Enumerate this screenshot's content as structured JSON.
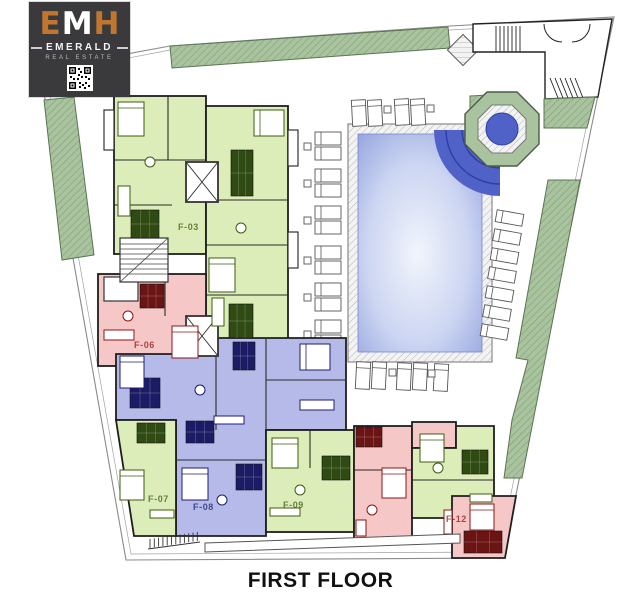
{
  "logo": {
    "letter_e": "E",
    "letter_m": "M",
    "letter_h": "H",
    "brand": "EMERALD",
    "subtitle": "REAL ESTATE"
  },
  "title": "FIRST FLOOR",
  "units": [
    {
      "id": "F-03",
      "color": "green"
    },
    {
      "id": "F-06",
      "color": "red"
    },
    {
      "id": "F-07",
      "color": "green"
    },
    {
      "id": "F-08",
      "color": "blue"
    },
    {
      "id": "F-09",
      "color": "green"
    },
    {
      "id": "F-12",
      "color": "red"
    }
  ],
  "icons": {
    "qr": "qr-code"
  },
  "colors": {
    "accent_orange": "#c0762f",
    "logo_bg": "#3a393b",
    "green_fill": "#dcedb9",
    "green_dark": "#3c5c10",
    "red_fill": "#f6c7c7",
    "red_dark": "#8c1616",
    "blue_fill": "#b5bae8",
    "blue_dark": "#1d1d72",
    "wall": "#1e1e1e",
    "landscape_fill": "#a8c39d",
    "landscape_line": "#7f9c76",
    "landscape_stroke": "#5a7552",
    "pool_edge": "#93a2de",
    "pool_center": "#f2f5fc",
    "pool_stairs": "#5061c8",
    "pool_stairs_line": "#2c3da6",
    "boundary": "#8a8a8a",
    "title_color": "#111111"
  }
}
